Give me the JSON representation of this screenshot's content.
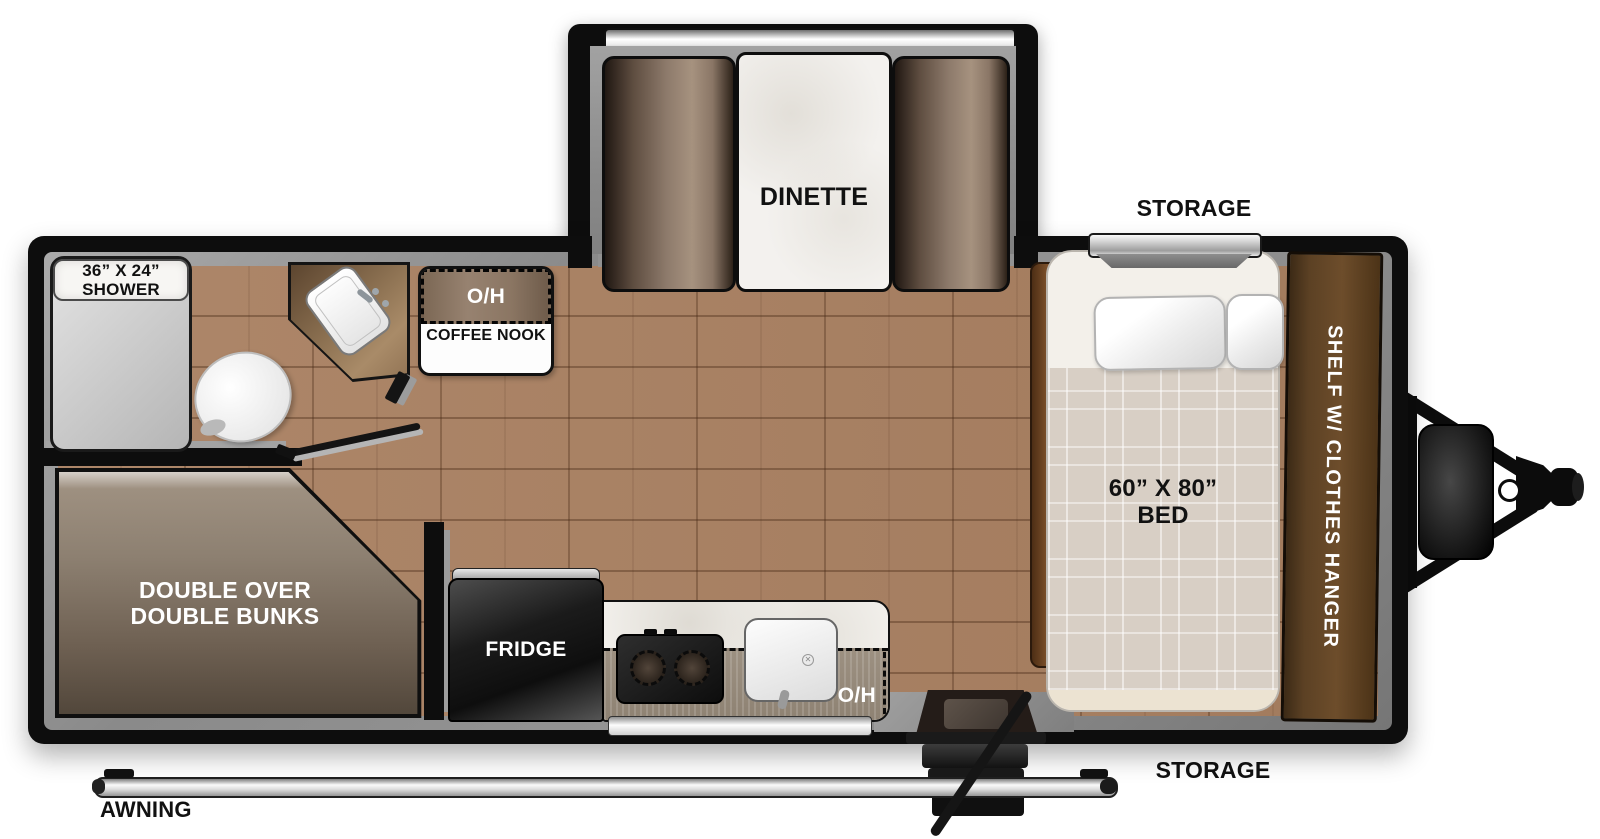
{
  "floorplan": {
    "slideout": {
      "dinette_label": "DINETTE"
    },
    "storage_rear": {
      "label": "STORAGE"
    },
    "storage_front": {
      "label": "STORAGE"
    },
    "awning": {
      "label": "AWNING"
    },
    "bathroom": {
      "shower_size": "36” X 24”",
      "shower_label": "SHOWER"
    },
    "coffee_nook": {
      "overhead_label": "O/H",
      "label": "COFFEE NOOK"
    },
    "bunks": {
      "line1": "DOUBLE OVER",
      "line2": "DOUBLE BUNKS"
    },
    "kitchen": {
      "fridge_label": "FRIDGE",
      "overhead_label": "O/H"
    },
    "bedroom": {
      "bed_size": "60” X 80”",
      "bed_label": "BED",
      "shelf_label": "SHELF W/ CLOTHES HANGER"
    },
    "colors": {
      "wall_black": "#0d0d0d",
      "liner_gray": "#8f8f8f",
      "floor_wood": "#a98061",
      "cabinet_brown": "#6d4d2b",
      "upholstery_brown": "#8d7a6b",
      "bedding_plaid": "#d8cfc5",
      "marble_white": "#f3f1ee"
    }
  }
}
